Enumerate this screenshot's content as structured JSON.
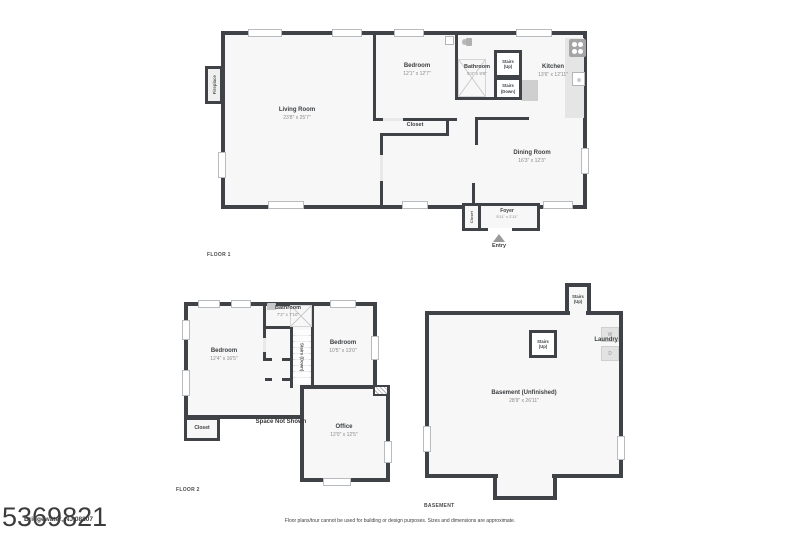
{
  "watermark": "5369821",
  "address": "Bridgewater, NJ 08807",
  "disclaimer": "Floor plans/tour cannot be used for building or design purposes. Sizes and dimensions are approximate.",
  "floor1": {
    "label": "FLOOR 1",
    "living_room": {
      "name": "Living Room",
      "dims": "23'8\" x 25'7\""
    },
    "bedroom": {
      "name": "Bedroom",
      "dims": "12'1\" x 12'7\""
    },
    "bathroom": {
      "name": "Bathroom",
      "dims": "5'4\" x 9'6\""
    },
    "kitchen": {
      "name": "Kitchen",
      "dims": "13'6\" x 12'11\""
    },
    "dining_room": {
      "name": "Dining Room",
      "dims": "16'3\" x 12'3\""
    },
    "foyer": {
      "name": "Foyer",
      "dims": "5'11\" x 2'11\""
    },
    "closet": "Closet",
    "foyer_closet": "Closet",
    "fireplace": "Fireplace",
    "stairs_up": "Stairs\n(Up)",
    "stairs_down": "Stairs\n(Down)",
    "entry": "Entry"
  },
  "floor2": {
    "label": "FLOOR 2",
    "bedroom_left": {
      "name": "Bedroom",
      "dims": "12'4\" x 16'5\""
    },
    "bedroom_right": {
      "name": "Bedroom",
      "dims": "10'5\" x 13'0\""
    },
    "bathroom": {
      "name": "Bathroom",
      "dims": "7'2\" x 7'10\""
    },
    "office": {
      "name": "Office",
      "dims": "12'0\" x 12'5\""
    },
    "closet": "Closet",
    "stairs_down": "Stairs (Down)",
    "space_not_shown": "Space Not Shown"
  },
  "basement": {
    "label": "BASEMENT",
    "room": {
      "name": "Basement (Unfinished)",
      "dims": "28'9\" x 26'11\""
    },
    "stairs_tower": "Stairs\n(Up)",
    "stairs_box": "Stairs\n(Up)",
    "laundry": "Laundry",
    "washer": "W",
    "dryer": "D"
  },
  "colors": {
    "wall": "#3f4246",
    "room_fill": "#f7f7f7"
  }
}
